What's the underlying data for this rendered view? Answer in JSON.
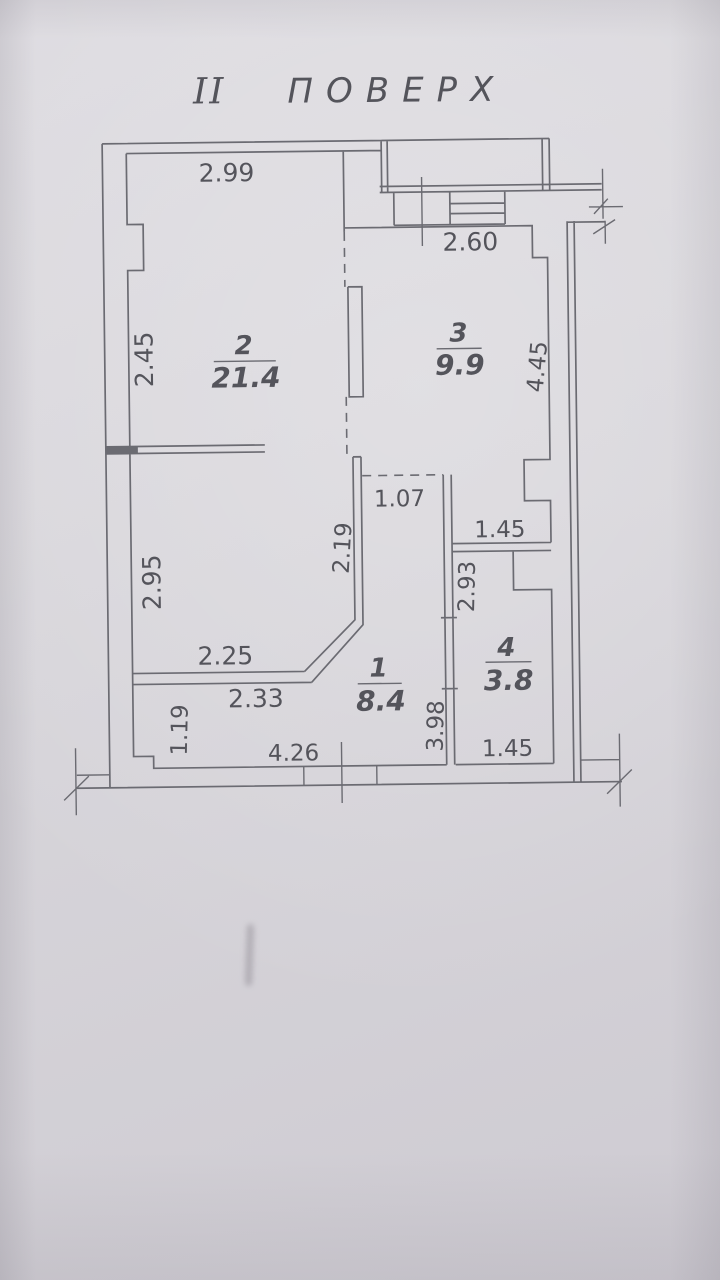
{
  "title": {
    "numeral": "II",
    "word": "ПОВЕРХ"
  },
  "rooms": [
    {
      "number": "1",
      "area": "8.4"
    },
    {
      "number": "2",
      "area": "21.4"
    },
    {
      "number": "3",
      "area": "9.9"
    },
    {
      "number": "4",
      "area": "3.8"
    }
  ],
  "dims": {
    "top_width": "2.99",
    "entry_width": "2.60",
    "left_upper": "2.45",
    "left_lower": "2.95",
    "left_bottom": "1.19",
    "opening": "1.07",
    "room3_passage_width": "1.45",
    "passage_height": "2.19",
    "room3_height": "4.45",
    "room2_bottom": "2.25",
    "room1_top": "2.33",
    "room1_bottom": "4.26",
    "room1_height": "3.98",
    "room4_height": "2.93",
    "room4_width": "1.45"
  },
  "colors": {
    "paper": "#d7d5da",
    "paper-light": "#dedce1",
    "paper-dark": "#cecbd2",
    "ink": "#6b6b72",
    "text": "#54545b"
  }
}
